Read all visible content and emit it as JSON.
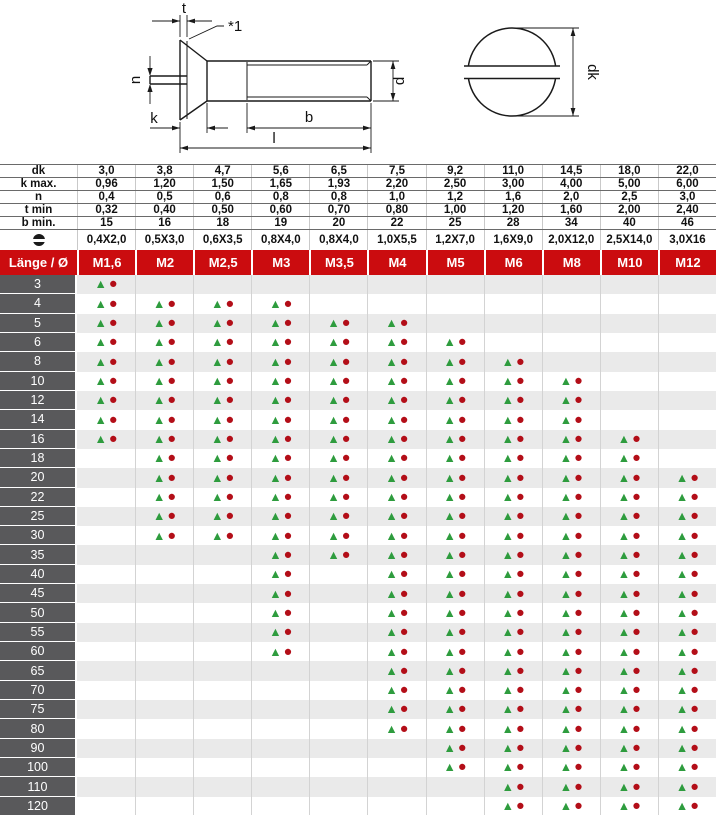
{
  "drawing": {
    "labels": {
      "t": "t",
      "footnote": "*1",
      "n": "n",
      "k": "k",
      "b": "b",
      "l": "l",
      "d": "d",
      "dk": "dk"
    }
  },
  "spec_table": {
    "rows": [
      {
        "label": "dk",
        "values": [
          "3,0",
          "3,8",
          "4,7",
          "5,6",
          "6,5",
          "7,5",
          "9,2",
          "11,0",
          "14,5",
          "18,0",
          "22,0"
        ]
      },
      {
        "label": "k max.",
        "values": [
          "0,96",
          "1,20",
          "1,50",
          "1,65",
          "1,93",
          "2,20",
          "2,50",
          "3,00",
          "4,00",
          "5,00",
          "6,00"
        ]
      },
      {
        "label": "n",
        "values": [
          "0,4",
          "0,5",
          "0,6",
          "0,8",
          "0,8",
          "1,0",
          "1,2",
          "1,6",
          "2,0",
          "2,5",
          "3,0"
        ]
      },
      {
        "label": "t min",
        "values": [
          "0,32",
          "0,40",
          "0,50",
          "0,60",
          "0,70",
          "0,80",
          "1,00",
          "1,20",
          "1,60",
          "2,00",
          "2,40"
        ]
      },
      {
        "label": "b min.",
        "values": [
          "15",
          "16",
          "18",
          "19",
          "20",
          "22",
          "25",
          "28",
          "34",
          "40",
          "46"
        ]
      },
      {
        "label": "slot-icon",
        "icon": true,
        "values": [
          "0,4X2,0",
          "0,5X3,0",
          "0,6X3,5",
          "0,8X4,0",
          "0,8X4,0",
          "1,0X5,5",
          "1,2X7,0",
          "1,6X9,0",
          "2,0X12,0",
          "2,5X14,0",
          "3,0X16"
        ]
      }
    ]
  },
  "size_table": {
    "header": {
      "label": "Länge / Ø",
      "columns": [
        "M1,6",
        "M2",
        "M2,5",
        "M3",
        "M3,5",
        "M4",
        "M5",
        "M6",
        "M8",
        "M10",
        "M12"
      ]
    },
    "legend": {
      "triangle": "▲",
      "circle": "●"
    },
    "rows": [
      {
        "length": "3",
        "available": [
          1,
          0,
          0,
          0,
          0,
          0,
          0,
          0,
          0,
          0,
          0
        ]
      },
      {
        "length": "4",
        "available": [
          1,
          1,
          1,
          1,
          0,
          0,
          0,
          0,
          0,
          0,
          0
        ]
      },
      {
        "length": "5",
        "available": [
          1,
          1,
          1,
          1,
          1,
          1,
          0,
          0,
          0,
          0,
          0
        ]
      },
      {
        "length": "6",
        "available": [
          1,
          1,
          1,
          1,
          1,
          1,
          1,
          0,
          0,
          0,
          0
        ]
      },
      {
        "length": "8",
        "available": [
          1,
          1,
          1,
          1,
          1,
          1,
          1,
          1,
          0,
          0,
          0
        ]
      },
      {
        "length": "10",
        "available": [
          1,
          1,
          1,
          1,
          1,
          1,
          1,
          1,
          1,
          0,
          0
        ]
      },
      {
        "length": "12",
        "available": [
          1,
          1,
          1,
          1,
          1,
          1,
          1,
          1,
          1,
          0,
          0
        ]
      },
      {
        "length": "14",
        "available": [
          1,
          1,
          1,
          1,
          1,
          1,
          1,
          1,
          1,
          0,
          0
        ]
      },
      {
        "length": "16",
        "available": [
          1,
          1,
          1,
          1,
          1,
          1,
          1,
          1,
          1,
          1,
          0
        ]
      },
      {
        "length": "18",
        "available": [
          0,
          1,
          1,
          1,
          1,
          1,
          1,
          1,
          1,
          1,
          0
        ]
      },
      {
        "length": "20",
        "available": [
          0,
          1,
          1,
          1,
          1,
          1,
          1,
          1,
          1,
          1,
          1
        ]
      },
      {
        "length": "22",
        "available": [
          0,
          1,
          1,
          1,
          1,
          1,
          1,
          1,
          1,
          1,
          1
        ]
      },
      {
        "length": "25",
        "available": [
          0,
          1,
          1,
          1,
          1,
          1,
          1,
          1,
          1,
          1,
          1
        ]
      },
      {
        "length": "30",
        "available": [
          0,
          1,
          1,
          1,
          1,
          1,
          1,
          1,
          1,
          1,
          1
        ]
      },
      {
        "length": "35",
        "available": [
          0,
          0,
          0,
          1,
          1,
          1,
          1,
          1,
          1,
          1,
          1
        ]
      },
      {
        "length": "40",
        "available": [
          0,
          0,
          0,
          1,
          0,
          1,
          1,
          1,
          1,
          1,
          1
        ]
      },
      {
        "length": "45",
        "available": [
          0,
          0,
          0,
          1,
          0,
          1,
          1,
          1,
          1,
          1,
          1
        ]
      },
      {
        "length": "50",
        "available": [
          0,
          0,
          0,
          1,
          0,
          1,
          1,
          1,
          1,
          1,
          1
        ]
      },
      {
        "length": "55",
        "available": [
          0,
          0,
          0,
          1,
          0,
          1,
          1,
          1,
          1,
          1,
          1
        ]
      },
      {
        "length": "60",
        "available": [
          0,
          0,
          0,
          1,
          0,
          1,
          1,
          1,
          1,
          1,
          1
        ]
      },
      {
        "length": "65",
        "available": [
          0,
          0,
          0,
          0,
          0,
          1,
          1,
          1,
          1,
          1,
          1
        ]
      },
      {
        "length": "70",
        "available": [
          0,
          0,
          0,
          0,
          0,
          1,
          1,
          1,
          1,
          1,
          1
        ]
      },
      {
        "length": "75",
        "available": [
          0,
          0,
          0,
          0,
          0,
          1,
          1,
          1,
          1,
          1,
          1
        ]
      },
      {
        "length": "80",
        "available": [
          0,
          0,
          0,
          0,
          0,
          1,
          1,
          1,
          1,
          1,
          1
        ]
      },
      {
        "length": "90",
        "available": [
          0,
          0,
          0,
          0,
          0,
          0,
          1,
          1,
          1,
          1,
          1
        ]
      },
      {
        "length": "100",
        "available": [
          0,
          0,
          0,
          0,
          0,
          0,
          1,
          1,
          1,
          1,
          1
        ]
      },
      {
        "length": "110",
        "available": [
          0,
          0,
          0,
          0,
          0,
          0,
          0,
          1,
          1,
          1,
          1
        ]
      },
      {
        "length": "120",
        "available": [
          0,
          0,
          0,
          0,
          0,
          0,
          0,
          1,
          1,
          1,
          1
        ]
      }
    ]
  },
  "colors": {
    "header_red": "#cb0c0f",
    "row_label_gray": "#59595b",
    "stripe_gray": "#eaeaea",
    "triangle_green": "#2e9c3e",
    "circle_red": "#b30e18",
    "drawing_line": "#1a1a1a"
  }
}
